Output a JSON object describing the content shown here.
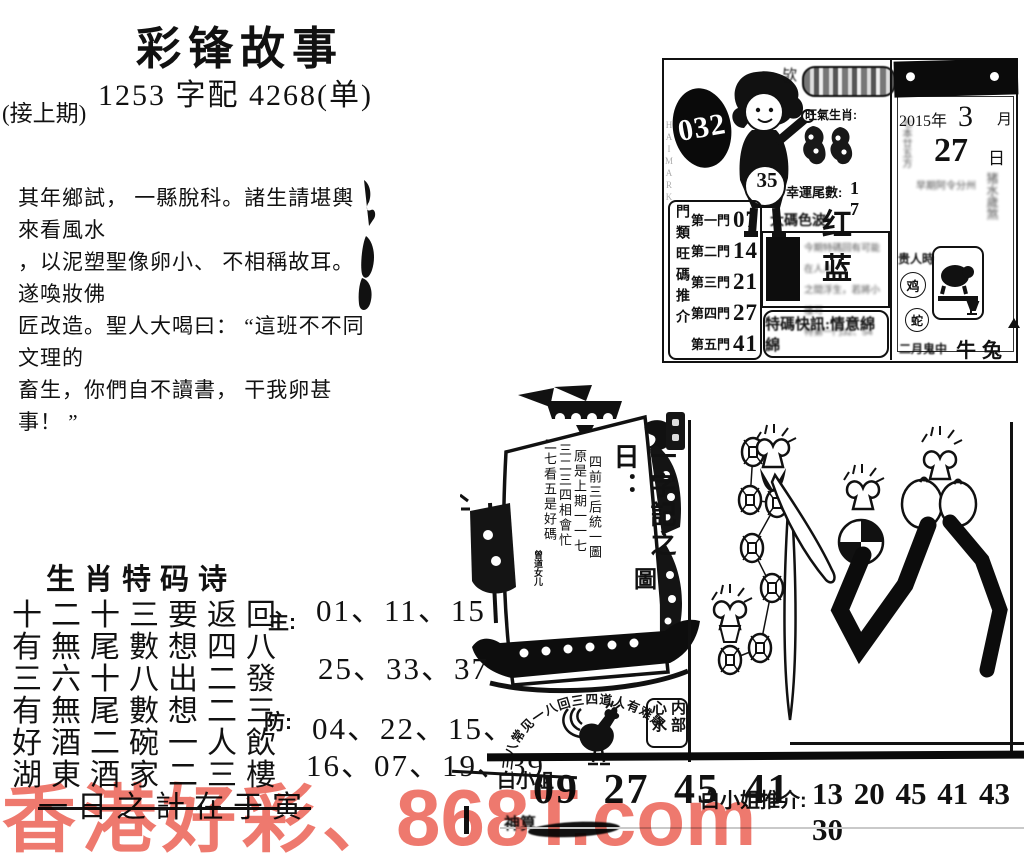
{
  "header": {
    "title": "彩锋故事",
    "subtitle": "1253 字配 4268(单)",
    "continued": "(接上期)"
  },
  "story": {
    "line1": "其年鄉試， 一縣脫科。諸生請堪輿來看風水",
    "line2": "，以泥塑聖像卵小、 不相稱故耳。遂喚妝佛",
    "line3": "匠改造。聖人大喝曰： “這班不不同文理的",
    "line4": "畜生，你們自不讀書， 干我卵甚事！ ”"
  },
  "card": {
    "issue": "032",
    "boy_badge": "35",
    "corner_char": "欤",
    "zodiac_label": "旺氣生肖:",
    "lucky_label": "幸運尾數:",
    "lucky_value": "1 7",
    "color_label": "大碼色波:",
    "color_value": "红 蓝",
    "door_col": "門類旺碼推介",
    "doors": [
      {
        "label": "第一門",
        "value": "07"
      },
      {
        "label": "第二門",
        "value": "14"
      },
      {
        "label": "第三門",
        "value": "21"
      },
      {
        "label": "第四門",
        "value": "27"
      },
      {
        "label": "第五門",
        "value": "41"
      }
    ],
    "notice": {
      "line1": "今期特碼回有可能在人八",
      "line2": "之間浮生，若將小樓可",
      "line3": "特第一門32、54"
    },
    "special": "特碼快訊:情意綿綿",
    "calendar": {
      "year": "2015年",
      "month": "3",
      "month_unit": "月",
      "day": "27",
      "day_unit": "日",
      "left_note": "七本廿五方",
      "smudge1": "猪水歲煞",
      "smudge2": "早期阿令分州",
      "noble": "贵人時",
      "z1": "鸡",
      "z2": "蛇",
      "bottom_small": "二月鬼中",
      "bottom_big": "牛兔"
    }
  },
  "sail": {
    "main": "一字記之日：",
    "answer": "圖",
    "col1": "四前三后統一圖",
    "col2": "原是上期一一七",
    "col3": "三二三四相會忙",
    "col4": "二七看五是好碼",
    "sig": "曾道女儿"
  },
  "arch": "三八常见一八回三四道人有难题",
  "stamp": {
    "right": "内部",
    "left": "心水"
  },
  "poem": {
    "title": "生肖特码诗",
    "line1": "十二十三要返回",
    "line2": "有無尾數想四八",
    "line3": "三六十八出二發",
    "line4": "有無尾數想二三",
    "line5": "好酒二碗一人飲",
    "line6": "湖東酒家二三樓",
    "line7": "一日之計在于寅",
    "main_label": "主:",
    "main1": "01、11、15",
    "main2": "25、33、37",
    "guard_label": "防:",
    "guard1": "04、22、15、",
    "guard2": "16、07、19、39"
  },
  "bottom": {
    "brand": "白小姐",
    "brand2": "神算",
    "numbers": "09 27 45 41",
    "rec_label": "白小姐推介:",
    "rec_numbers": "13 20 45 41 43 30"
  },
  "watermark": {
    "part1": "香港好彩",
    "part2": "、",
    "part3": "868T.com",
    "color": "#ed6a5e"
  }
}
